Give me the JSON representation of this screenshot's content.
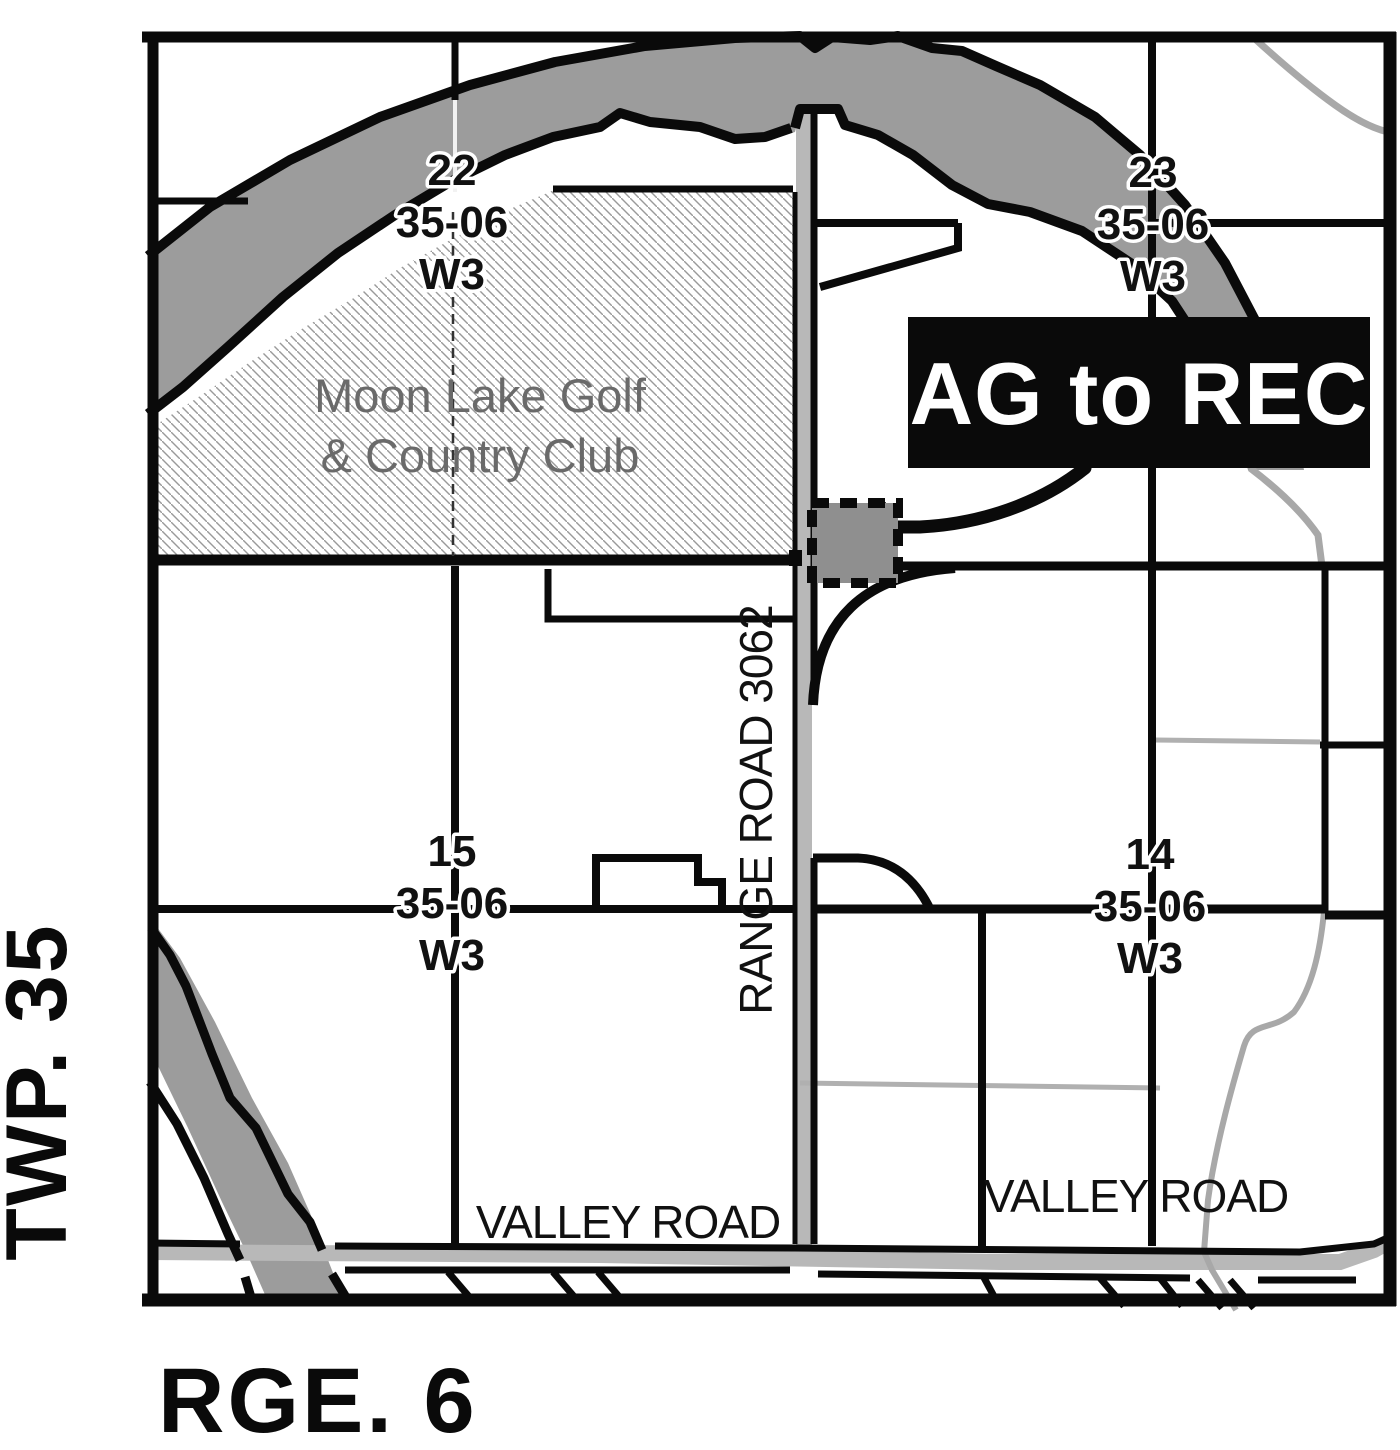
{
  "map": {
    "margin_labels": {
      "township": "TWP. 35",
      "range": "RGE. 6"
    },
    "callout": {
      "label": "AG to REC"
    },
    "sections": [
      {
        "number": "22",
        "township_range": "35-06",
        "meridian": "W3"
      },
      {
        "number": "23",
        "township_range": "35-06",
        "meridian": "W3"
      },
      {
        "number": "15",
        "township_range": "35-06",
        "meridian": "W3"
      },
      {
        "number": "14",
        "township_range": "35-06",
        "meridian": "W3"
      }
    ],
    "landmarks": {
      "golf_line1": "Moon Lake Golf",
      "golf_line2": "& Country Club"
    },
    "roads": {
      "range_road": "RANGE ROAD 3062",
      "valley_road_west": "VALLEY ROAD",
      "valley_road_east": "VALLEY ROAD"
    },
    "colors": {
      "river": "#9c9c9c",
      "road_gray": "#b8b8b8",
      "trail_gray": "#a8a8a8",
      "ink": "#0a0a0a",
      "golf_text": "#6a6a6a",
      "hatch": "#9a9a9a",
      "callout_bg": "#0a0a0a",
      "callout_text": "#ffffff",
      "subject_parcel_fill": "#8f8f8f"
    }
  }
}
